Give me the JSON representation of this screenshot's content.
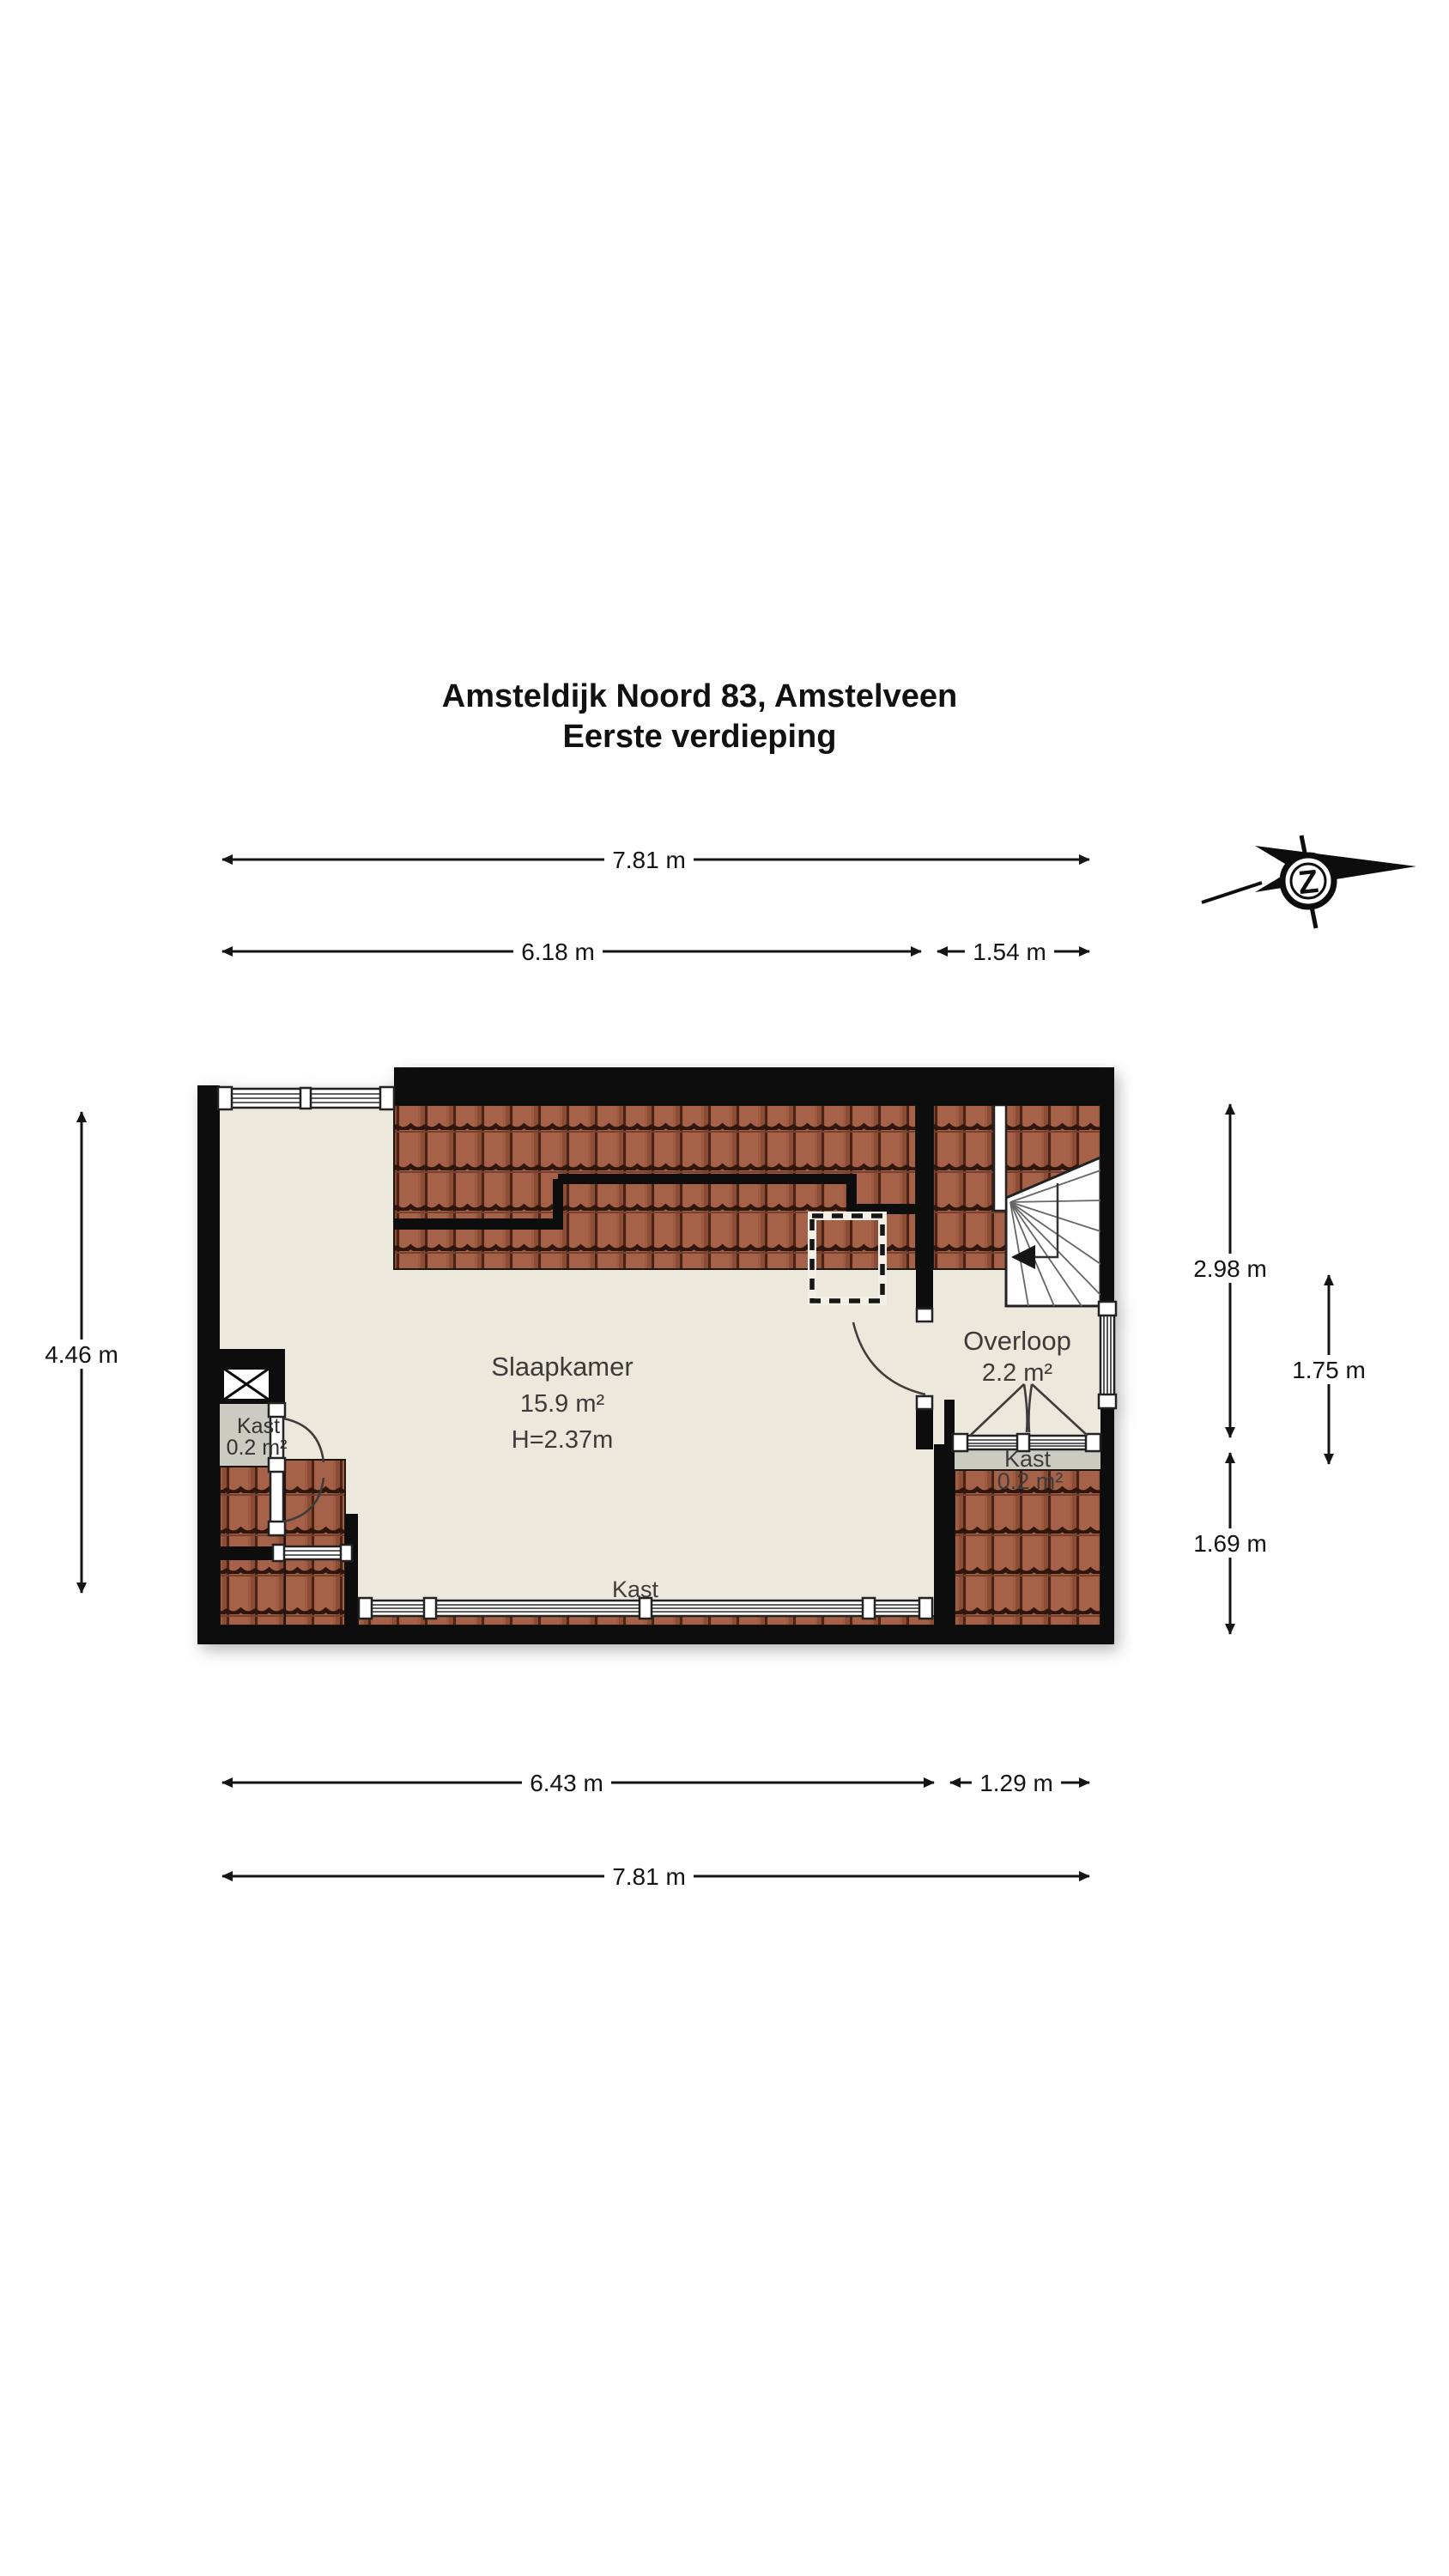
{
  "title": {
    "line1": "Amsteldijk Noord 83, Amstelveen",
    "line2": "Eerste verdieping"
  },
  "compass": {
    "letter": "Z"
  },
  "rooms": {
    "slaapkamer": {
      "name": "Slaapkamer",
      "area": "15.9 m²",
      "height": "H=2.37m"
    },
    "overloop": {
      "name": "Overloop",
      "area": "2.2 m²"
    },
    "kast_left": {
      "name": "Kast",
      "area": "0.2 m²"
    },
    "kast_right": {
      "name": "Kast",
      "area": "0.2 m²"
    },
    "kast_bottom": {
      "name": "Kast"
    }
  },
  "dimensions": {
    "top_outer": "7.81 m",
    "top_inner_left": "6.18 m",
    "top_inner_right": "1.54 m",
    "left_height": "4.46 m",
    "right_upper": "2.98 m",
    "right_inner": "1.75 m",
    "right_lower": "1.69 m",
    "bottom_inner_left": "6.43 m",
    "bottom_inner_right": "1.29 m",
    "bottom_outer": "7.81 m"
  }
}
